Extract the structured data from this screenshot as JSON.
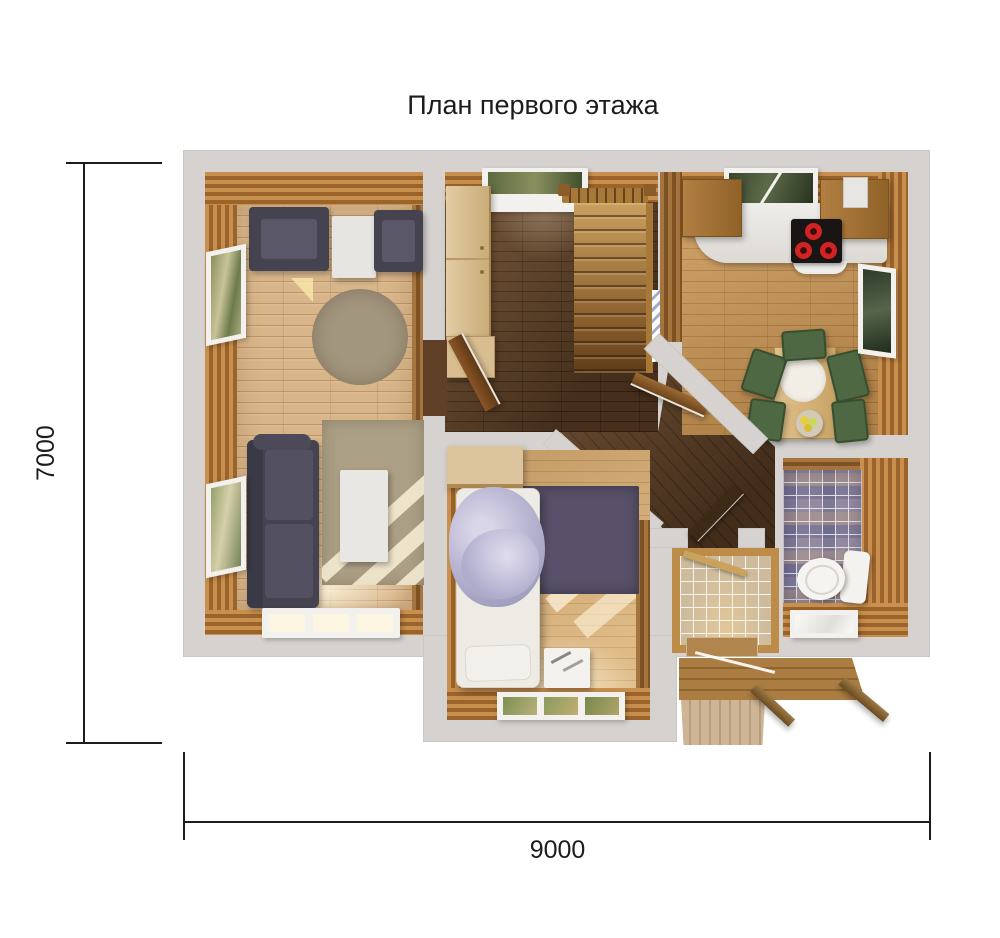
{
  "title": "План первого этажа",
  "dimensions": {
    "vertical": "7000",
    "horizontal": "9000"
  },
  "rooms": [
    "living-room",
    "hallway",
    "staircase",
    "kitchen",
    "dining-area",
    "corridor",
    "vestibule",
    "bathroom",
    "bedroom",
    "porch"
  ],
  "furniture": [
    "armchair",
    "side-table",
    "sofa",
    "coffee-table",
    "round-rug",
    "wardrobe",
    "stairs",
    "kitchen-counter",
    "cooktop",
    "dining-table",
    "green-chairs",
    "fruit-bowl",
    "bed",
    "nightstand",
    "toilet",
    "deck-steps"
  ],
  "colors": {
    "wall": "#d5d2cf",
    "panel": "#c08347",
    "paneldark": "#8a5a28",
    "floorliving": "#d9b68a",
    "floorhall": "#5f4026",
    "floorkitchen": "#c9995a",
    "floorbedroom": "#d6ad74",
    "navy": "#45434f",
    "green": "#4d6843",
    "ruground": "#a3967e",
    "rugrect": "#ab9f85",
    "rugbed": "#585169",
    "counter": "#efedea",
    "cooktop": "#181514",
    "burner": "#d32222",
    "tilebath": "#938aa0",
    "tilevest": "#cdbb9c",
    "blanket": "#b9b6d3",
    "deck": "#a97c42",
    "trim": "#bd8c49",
    "white": "#f3f1ed",
    "dim": "#1c1c1c"
  }
}
